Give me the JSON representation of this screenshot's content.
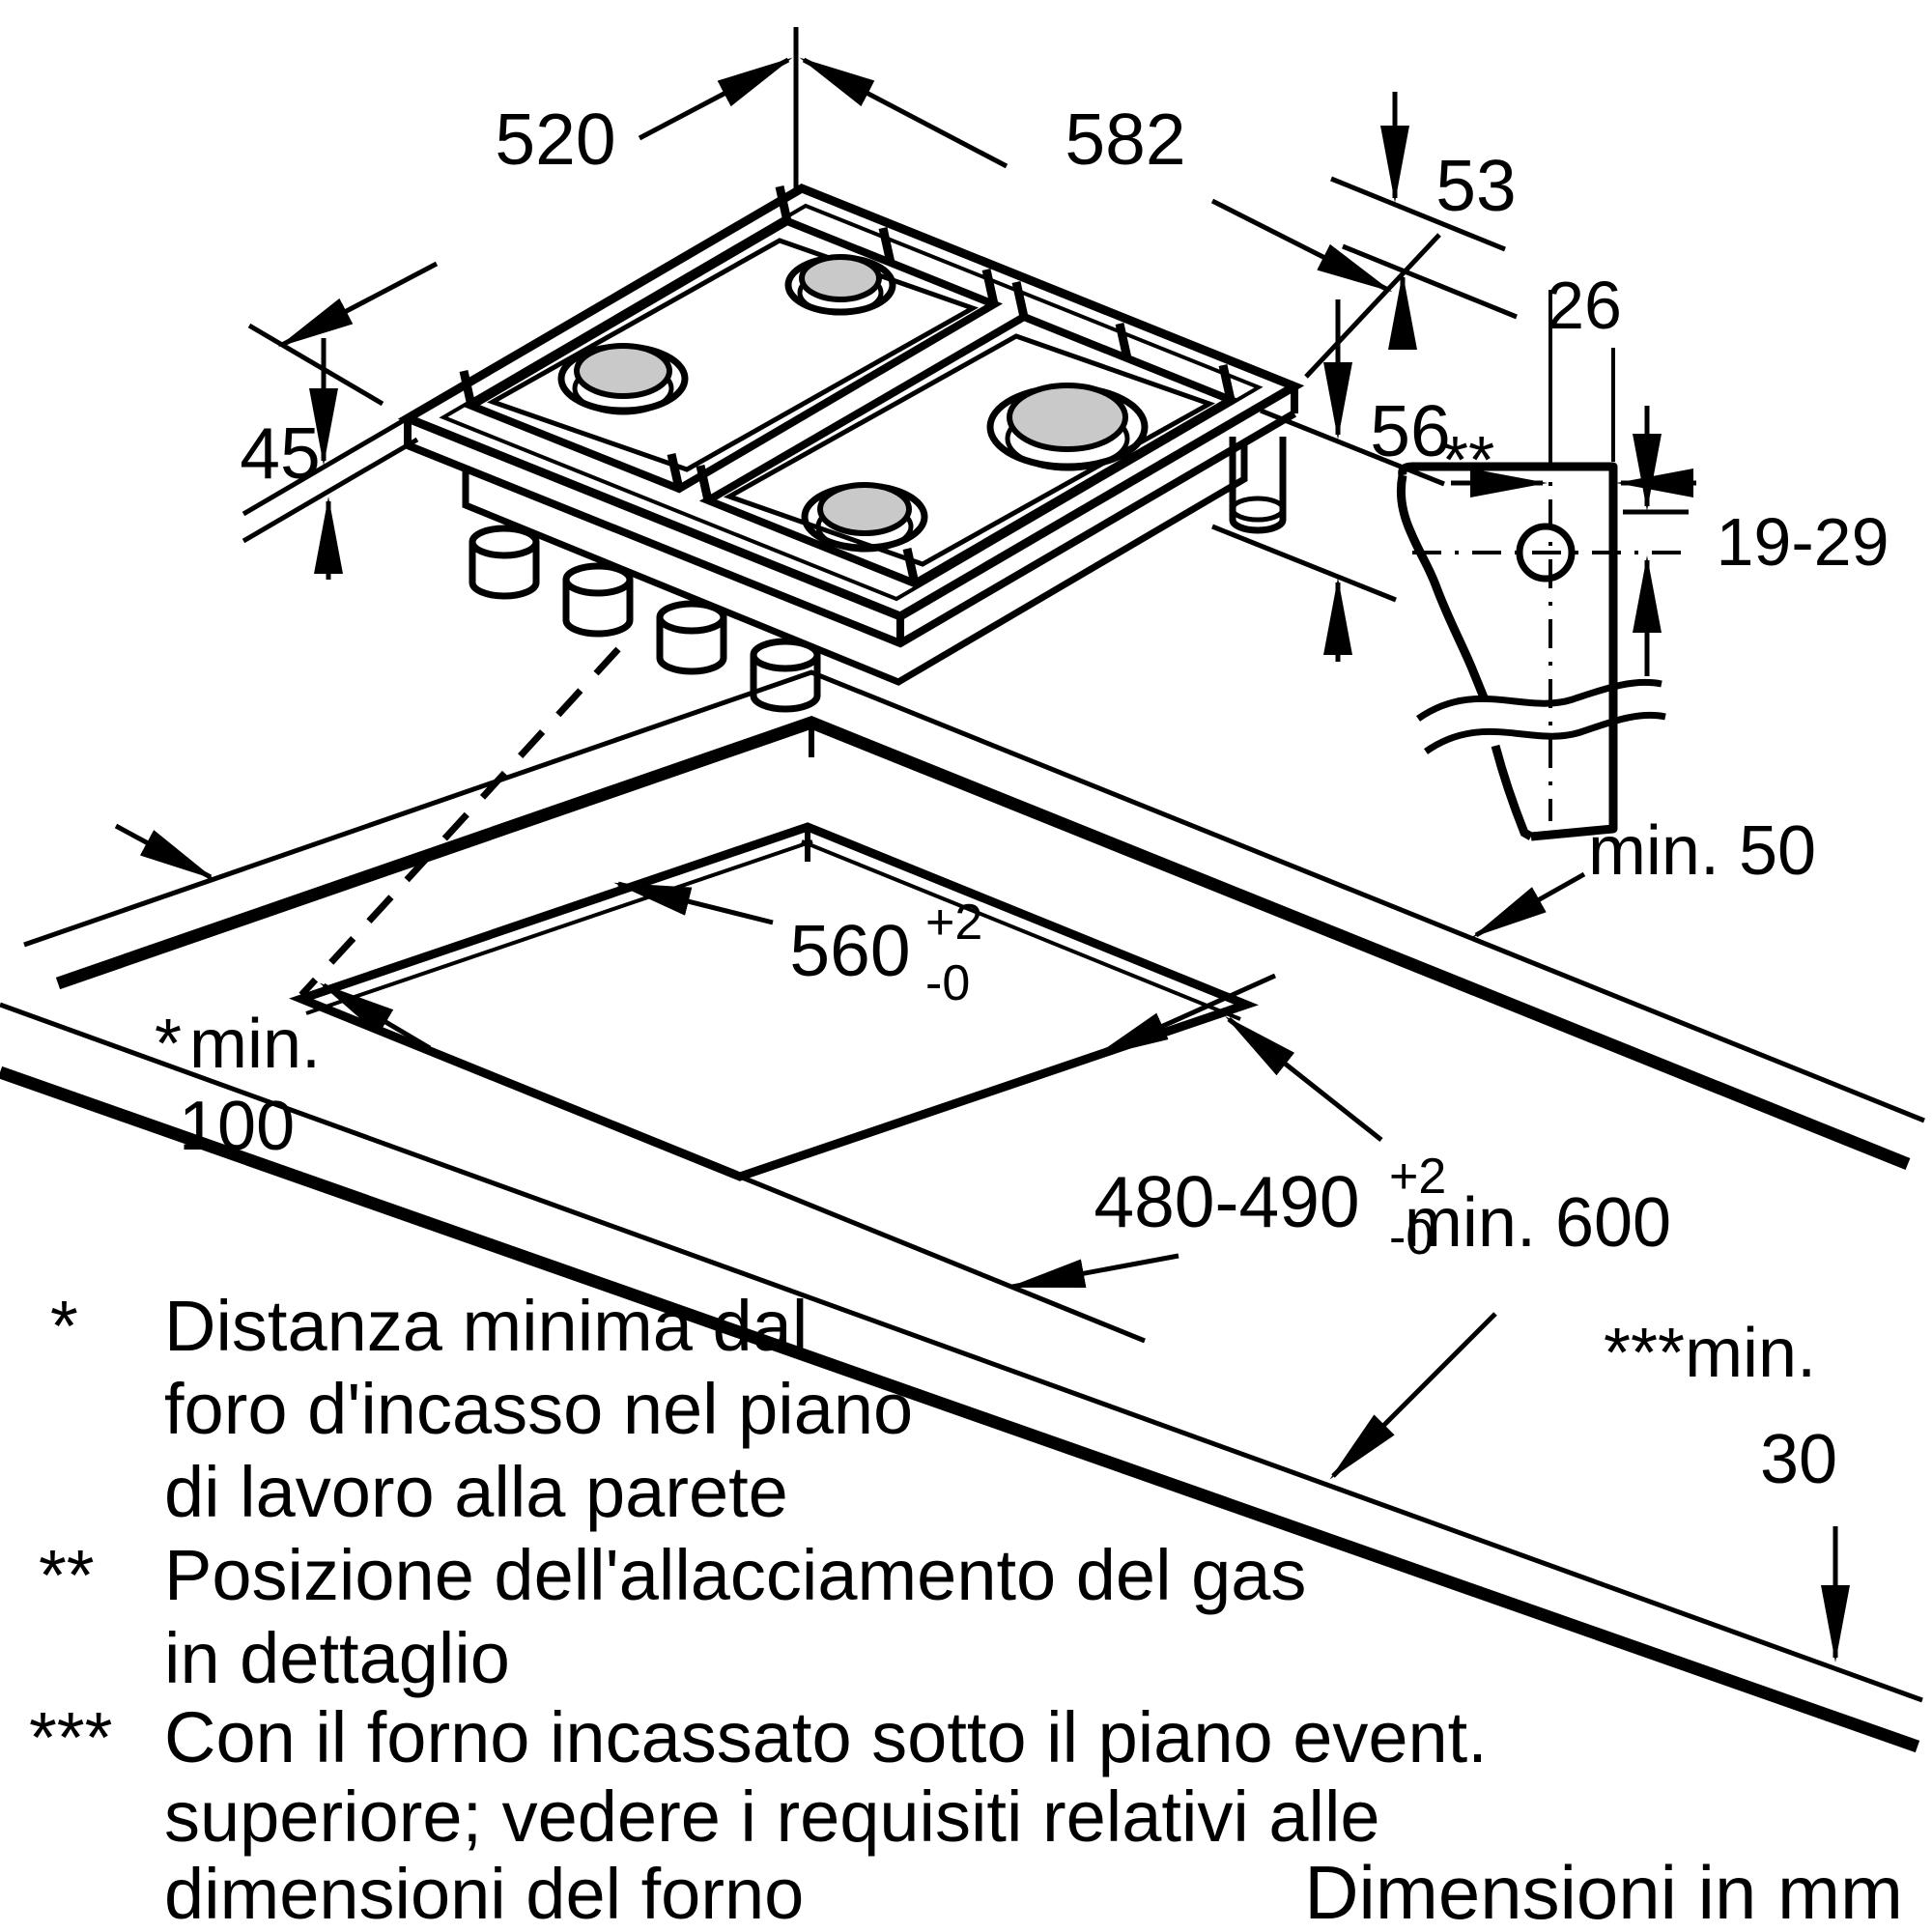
{
  "diagram": {
    "title_note": "Dimensioni in mm",
    "colors": {
      "line": "#000000",
      "background": "#ffffff",
      "burner_cap": "#c9c9c9"
    },
    "hob": {
      "depth_label": "520",
      "width_label": "582",
      "edge_height_label": "45",
      "top_height_label": "53",
      "body_height_label": "56"
    },
    "gas_detail": {
      "marker": "**",
      "offset_label": "26",
      "height_range_label": "19-29"
    },
    "cutout": {
      "width": {
        "value": "560",
        "tol_plus": "+2",
        "tol_minus": "-0"
      },
      "depth": {
        "value": "480-490",
        "tol_plus": "+2",
        "tol_minus": "-0"
      },
      "wall_gap_label": "min. 50",
      "side_gap": {
        "marker": "*",
        "line1": "min.",
        "line2": "100"
      },
      "front_depth_label": "min. 600",
      "oven_gap": {
        "marker": "***",
        "line1": "min.",
        "line2": "30"
      }
    },
    "footnotes": [
      {
        "marker": "*",
        "lines": [
          "Distanza minima dal",
          "foro d'incasso nel piano",
          "di lavoro alla parete"
        ]
      },
      {
        "marker": "**",
        "lines": [
          "Posizione dell'allacciamento del gas",
          "in dettaglio"
        ]
      },
      {
        "marker": "***",
        "lines": [
          "Con il forno incassato sotto il piano event.",
          "superiore; vedere i requisiti relativi alle",
          "dimensioni del forno"
        ]
      }
    ]
  }
}
